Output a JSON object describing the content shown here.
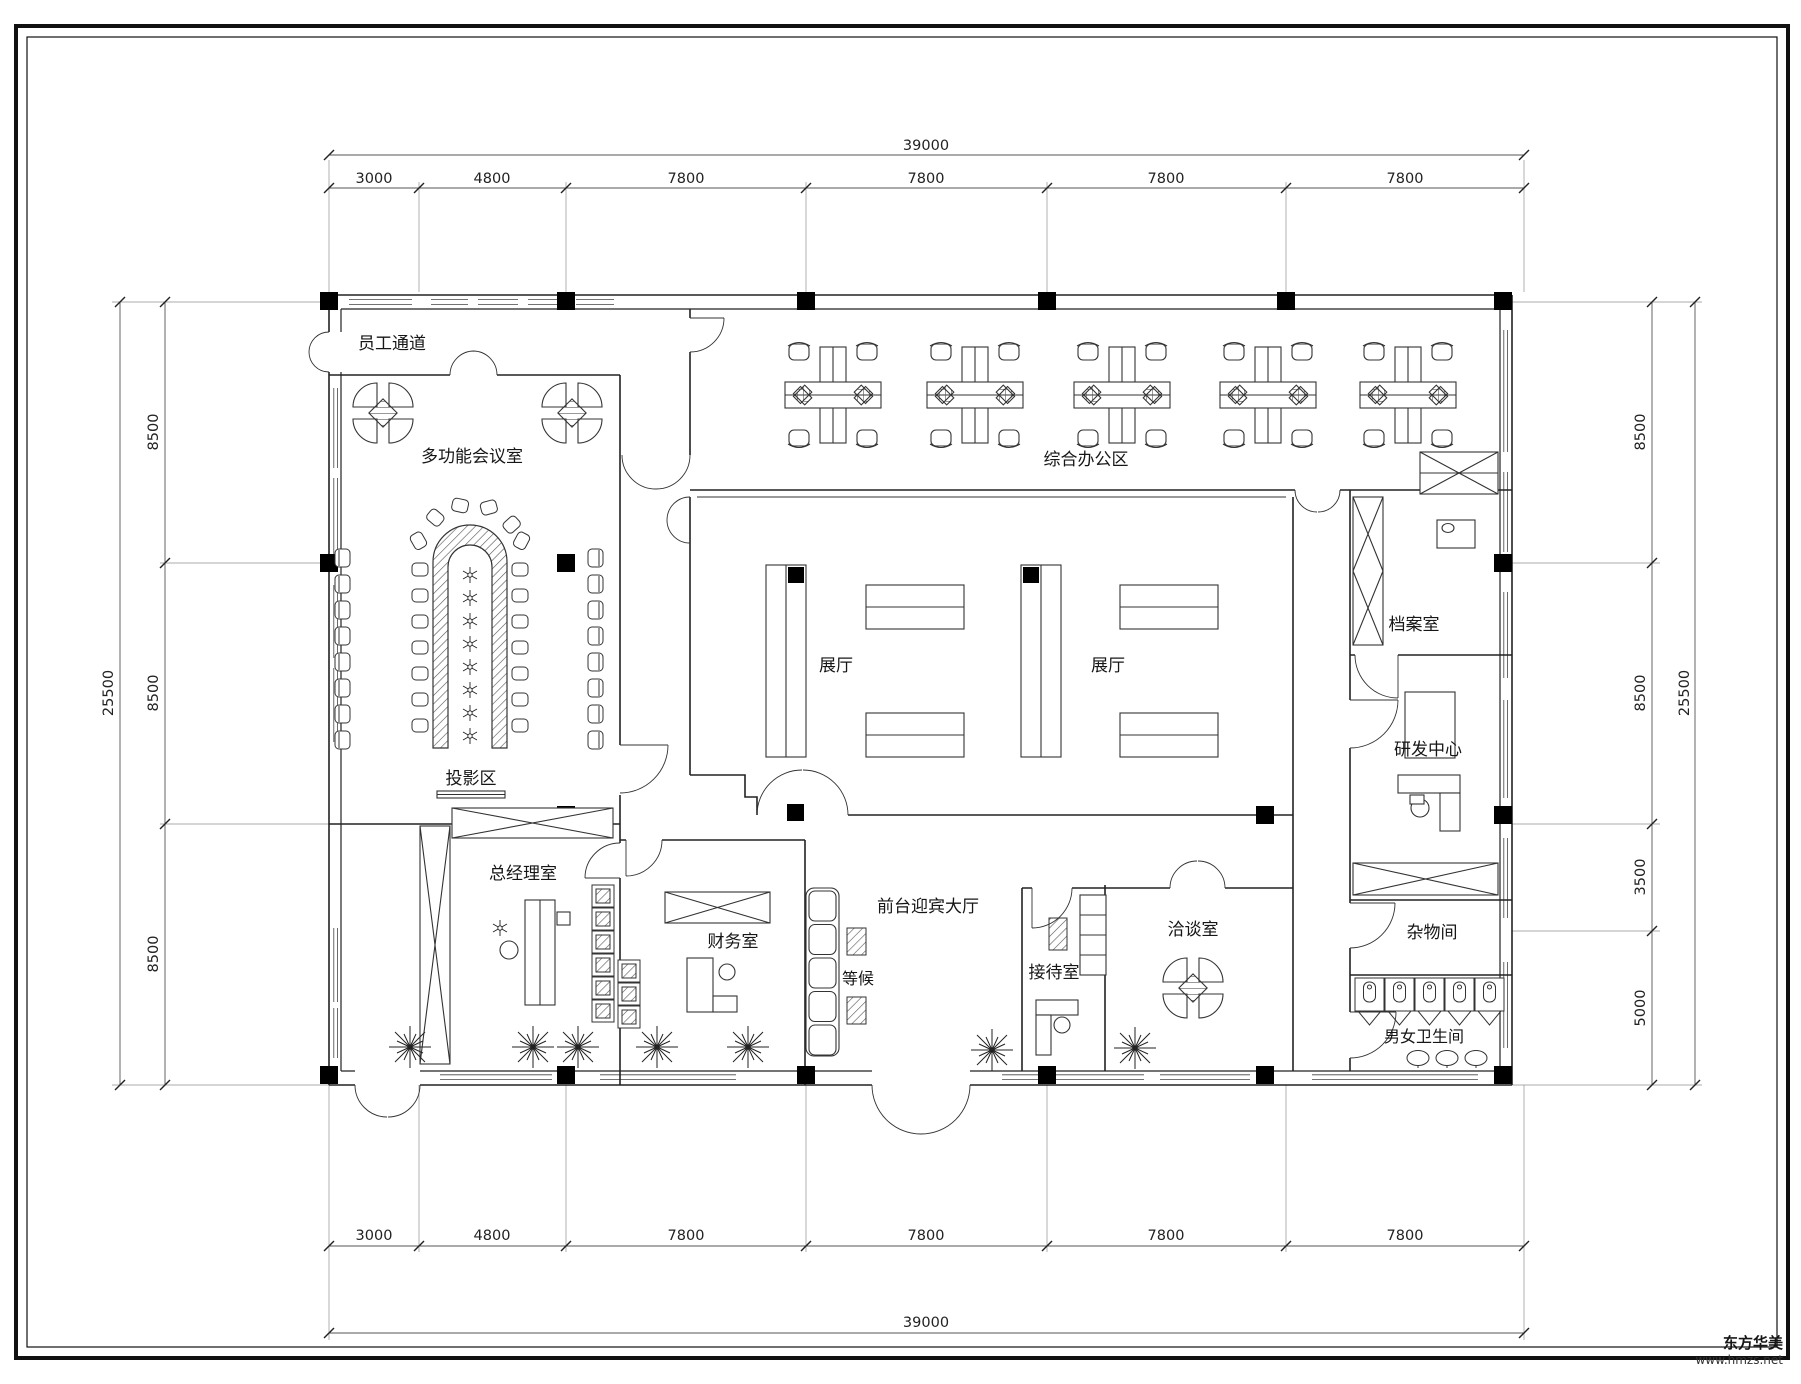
{
  "rooms": {
    "staff_corridor": "员工通道",
    "meeting_room": "多功能会议室",
    "office_area": "综合办公区",
    "exhibition1": "展厅",
    "exhibition2": "展厅",
    "archive": "档案室",
    "rnd_center": "研发中心",
    "projection": "投影区",
    "gm_office": "总经理室",
    "finance": "财务室",
    "waiting": "等候",
    "lobby": "前台迎宾大厅",
    "reception": "接待室",
    "negotiation": "洽谈室",
    "storage": "杂物间",
    "toilets": "男女卫生间"
  },
  "dims": {
    "top": {
      "total": "39000",
      "segs": [
        "3000",
        "4800",
        "7800",
        "7800",
        "7800",
        "7800"
      ]
    },
    "bottom": {
      "total": "39000",
      "segs": [
        "3000",
        "4800",
        "7800",
        "7800",
        "7800",
        "7800"
      ]
    },
    "left": {
      "total": "25500",
      "segs": [
        "8500",
        "8500",
        "8500"
      ]
    },
    "right": {
      "total": "25500",
      "segs": [
        "8500",
        "8500",
        "3500",
        "5000"
      ]
    }
  },
  "watermark": {
    "brand": "东方华美",
    "site": "www.hmzs.net"
  },
  "colors": {
    "ink": "#1a1a1a",
    "paper": "#ffffff"
  }
}
